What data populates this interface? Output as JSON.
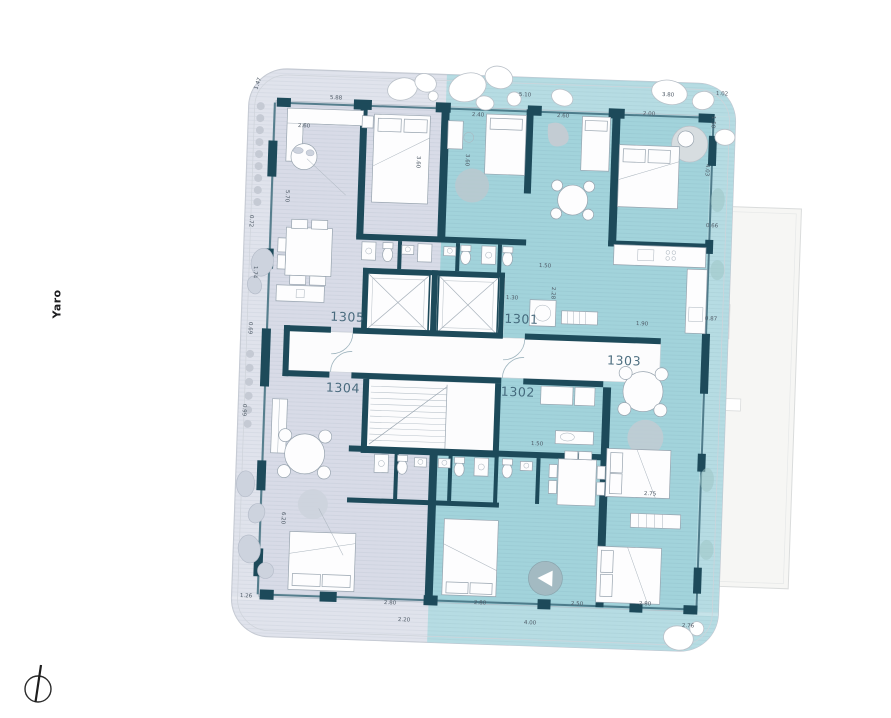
{
  "project": {
    "name": "Yaro"
  },
  "units": [
    {
      "id": "1305",
      "label": "1305"
    },
    {
      "id": "1301",
      "label": "1301"
    },
    {
      "id": "1304",
      "label": "1304"
    },
    {
      "id": "1302",
      "label": "1302"
    },
    {
      "id": "1303",
      "label": "1303"
    }
  ],
  "compass": {
    "icon": "north-arrow"
  },
  "colors": {
    "zone_left": "#d8dbe7",
    "zone_right": "#a2d3db",
    "wall": "#1d4a5a",
    "terrace": "#f6f6f4",
    "unit_label": "#3d6175"
  },
  "dimensions": [
    {
      "t": "5.88",
      "x": 336,
      "y": 99
    },
    {
      "t": "5.10",
      "x": 525,
      "y": 96
    },
    {
      "t": "3.80",
      "x": 668,
      "y": 96
    },
    {
      "t": "1.02",
      "x": 722,
      "y": 95
    },
    {
      "t": "2.60",
      "x": 304,
      "y": 127
    },
    {
      "t": "2.40",
      "x": 478,
      "y": 116
    },
    {
      "t": "2.60",
      "x": 563,
      "y": 117
    },
    {
      "t": "2.00",
      "x": 649,
      "y": 115
    },
    {
      "t": "1.50",
      "x": 712,
      "y": 122,
      "r": 92
    },
    {
      "t": "1.47",
      "x": 259,
      "y": 84,
      "r": -70
    },
    {
      "t": "5.70",
      "x": 286,
      "y": 196,
      "r": 92
    },
    {
      "t": "0.72",
      "x": 250,
      "y": 221,
      "r": 92
    },
    {
      "t": "1.74",
      "x": 254,
      "y": 272,
      "r": 92
    },
    {
      "t": "0.69",
      "x": 249,
      "y": 328,
      "r": 92
    },
    {
      "t": "0.99",
      "x": 243,
      "y": 410,
      "r": 92
    },
    {
      "t": "6.20",
      "x": 282,
      "y": 518,
      "r": 92
    },
    {
      "t": "1.26",
      "x": 246,
      "y": 597
    },
    {
      "t": "2.20",
      "x": 404,
      "y": 621
    },
    {
      "t": "4.00",
      "x": 530,
      "y": 624
    },
    {
      "t": "2.76",
      "x": 688,
      "y": 627
    },
    {
      "t": "2.80",
      "x": 390,
      "y": 604
    },
    {
      "t": "2.80",
      "x": 480,
      "y": 604
    },
    {
      "t": "2.50",
      "x": 577,
      "y": 605
    },
    {
      "t": "2.80",
      "x": 645,
      "y": 605
    },
    {
      "t": "0.66",
      "x": 712,
      "y": 227
    },
    {
      "t": "0.87",
      "x": 711,
      "y": 320
    },
    {
      "t": "4.03",
      "x": 706,
      "y": 170,
      "r": 92
    },
    {
      "t": "1.30",
      "x": 512,
      "y": 299
    },
    {
      "t": "2.28",
      "x": 552,
      "y": 293,
      "r": 92
    },
    {
      "t": "1.50",
      "x": 545,
      "y": 267
    },
    {
      "t": "1.90",
      "x": 642,
      "y": 325
    },
    {
      "t": "3.60",
      "x": 417,
      "y": 162,
      "r": 92
    },
    {
      "t": "3.60",
      "x": 466,
      "y": 160,
      "r": 92
    },
    {
      "t": "2.75",
      "x": 650,
      "y": 495
    },
    {
      "t": "1.50",
      "x": 537,
      "y": 445
    }
  ]
}
